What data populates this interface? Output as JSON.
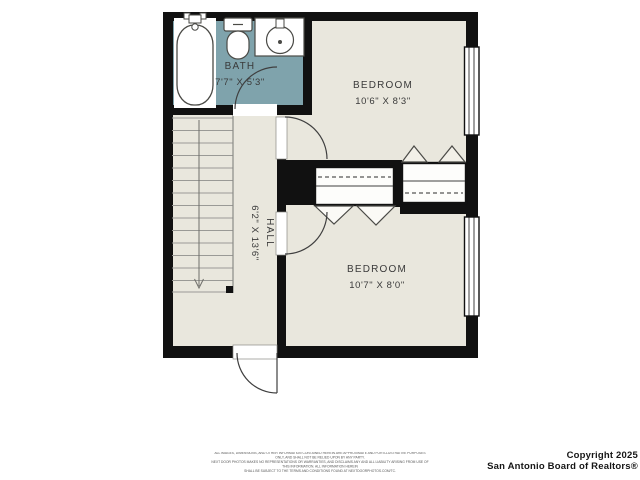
{
  "plan": {
    "rooms": {
      "bath": {
        "name": "BATH",
        "dims": "7'7\" X 5'3\""
      },
      "bedroom_top": {
        "name": "BEDROOM",
        "dims": "10'6\" X 8'3\""
      },
      "bedroom_bottom": {
        "name": "BEDROOM",
        "dims": "10'7\" X 8'0\""
      },
      "hall": {
        "name": "HALL",
        "dims": "6'2\" X 13'6\""
      }
    },
    "fixtures": [
      "bathtub-icon",
      "toilet-icon",
      "sink-icon",
      "stairs",
      "stair-direction-arrow-icon",
      "closet-rod-line",
      "bifold-door-icon",
      "door-swing-arc-icon",
      "window-icon"
    ],
    "colors": {
      "floor": "#e9e7dd",
      "bath_floor": "#7fa3ac",
      "wall": "#111111",
      "line": "#3f3f3f"
    }
  },
  "footer": {
    "disclaimer": [
      "ALL IMAGES, DIMENSIONS, AND OTHER INFORMATION CONTAINED HEREIN ARE APPROXIMATE AND FOR ILLUSTRATIVE PURPOSES ONLY, AND SHALL NOT BE RELIED UPON BY ANY PARTY.",
      "NEXT DOOR PHOTOS MAKES NO REPRESENTATIONS OR WARRANTIES, AND DISCLAIMS ANY AND ALL LIABILITY ARISING FROM USE OF THIS INFORMATION. ALL INFORMATION HEREIN",
      "SHALL BE SUBJECT TO THE TERMS AND CONDITIONS FOUND AT NEXTDOORPHOTOS.COM/TC."
    ],
    "copyright_line1": "Copyright 2025",
    "copyright_line2": "San Antonio Board of Realtors®"
  }
}
